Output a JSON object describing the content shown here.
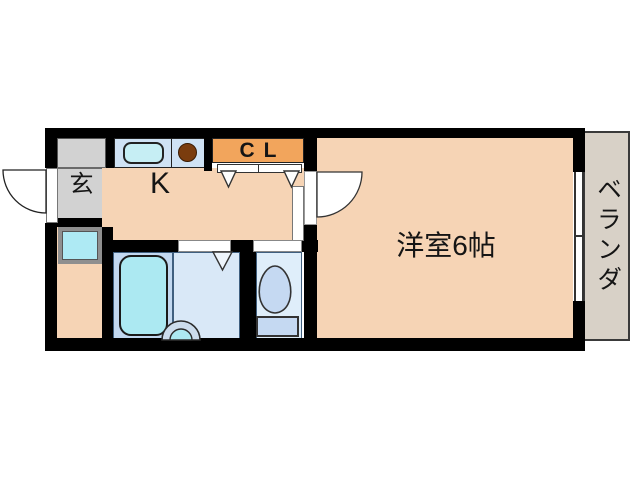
{
  "title": "apartment floor plan",
  "rooms": {
    "entrance": {
      "label": "玄"
    },
    "kitchen": {
      "label": "K"
    },
    "closet": {
      "label": "CL"
    },
    "main_room": {
      "label": "洋室6帖"
    },
    "veranda": {
      "label": "ベランダ"
    }
  },
  "fixtures": [
    "kitchen-sink",
    "stove-burner",
    "washing-machine-pan",
    "bathtub",
    "washbasin",
    "toilet",
    "sliding-window",
    "entrance-door",
    "room-door",
    "closet-sliding-doors",
    "folding-door"
  ],
  "colors": {
    "wall": "#000000",
    "room_fill": "#f6d4b5",
    "entrance_fill": "#d2d2d2",
    "closet_fill": "#f2a55c",
    "water_cyan": "#aeeaf4",
    "bath_fill": "#c2d8f0",
    "washroom_fill": "#d9e8f7",
    "toilet_fill": "#dfeefa",
    "counter_fill": "#cfe2f4",
    "veranda_fill": "#d8d1c7",
    "burner_brown": "#7a3c0e",
    "background": "#ffffff"
  }
}
